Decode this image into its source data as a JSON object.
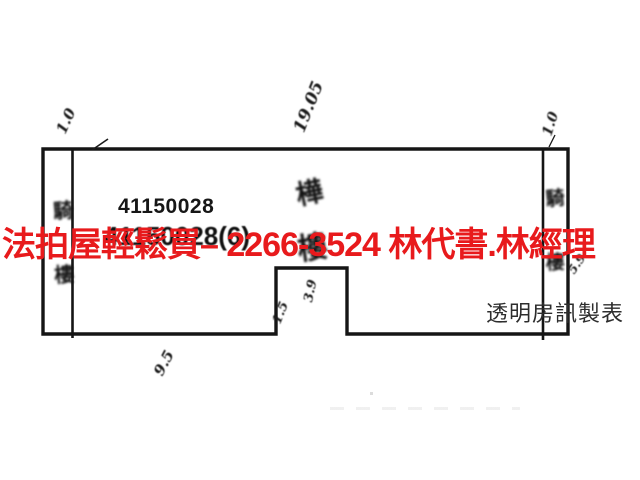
{
  "overlay": {
    "ad_text": "法拍屋輕鬆買– 2266-3524  林代書.林經理",
    "ad_color": "#e81a1c"
  },
  "plan": {
    "building_number": "41150028",
    "building_number_sub": "41150028(6)",
    "publisher_credit": "透明房訊製表",
    "center_label_chars": [
      "樺",
      "樓"
    ],
    "left_strip_chars": [
      "騎",
      "樓"
    ],
    "right_strip_chars": [
      "騎",
      "樓"
    ],
    "dimensions": {
      "top_width": "19.05",
      "left_strip": "1.0",
      "right_strip": "1.0",
      "bottom_left": "9.5",
      "notch_width": "1.5",
      "notch_depth": "3.9",
      "right_depth": "5.9"
    },
    "line_color": "#151515"
  }
}
